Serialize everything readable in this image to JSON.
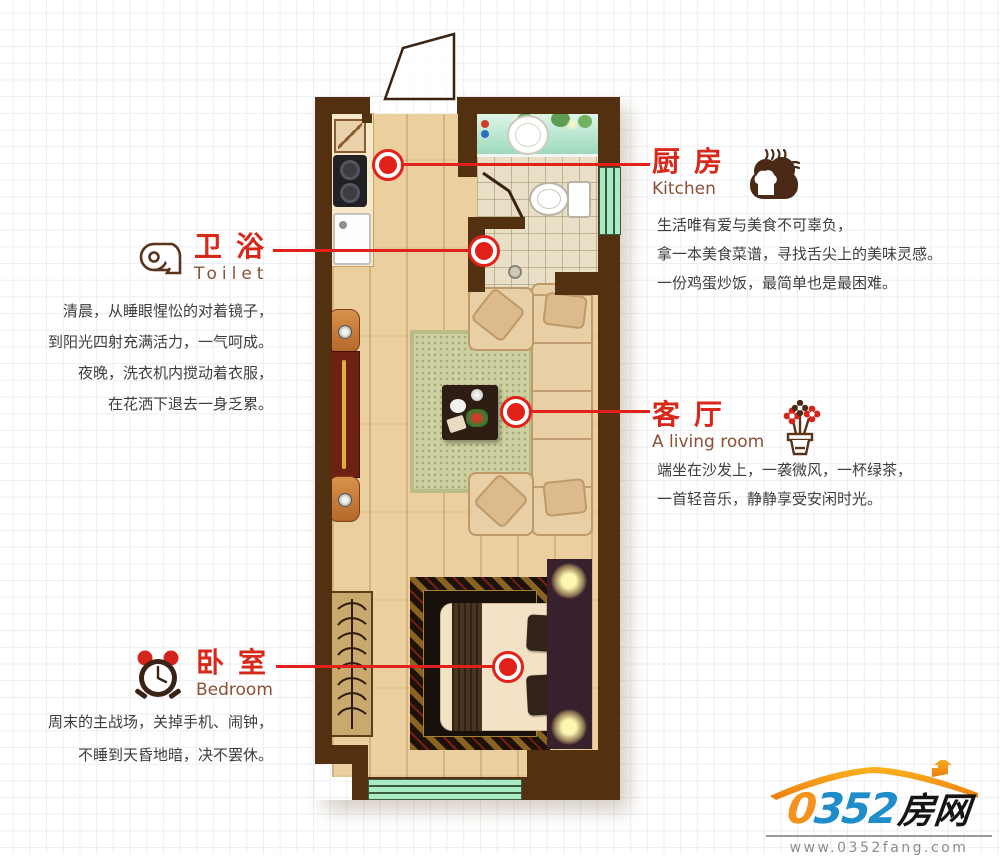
{
  "sections": {
    "kitchen": {
      "title_zh": "厨房",
      "title_en": "Kitchen",
      "icon": "bread-icon",
      "lines": [
        "生活唯有爱与美食不可辜负，",
        "拿一本美食菜谱，寻找舌尖上的美味灵感。",
        "一份鸡蛋炒饭，最简单也是最困难。"
      ]
    },
    "toilet": {
      "title_zh": "卫浴",
      "title_en": "Toilet",
      "icon": "toilet-paper-icon",
      "lines": [
        "清晨，从睡眼惺忪的对着镜子，",
        "到阳光四射充满活力，一气呵成。",
        "夜晚，洗衣机内搅动着衣服，",
        "在花洒下退去一身乏累。"
      ]
    },
    "living": {
      "title_zh": "客厅",
      "title_en": "A living room",
      "icon": "flower-pot-icon",
      "lines": [
        "端坐在沙发上，一袭微风，一杯绿茶，",
        "一首轻音乐，静静享受安闲时光。"
      ]
    },
    "bedroom": {
      "title_zh": "卧室",
      "title_en": "Bedroom",
      "icon": "alarm-clock-icon",
      "lines": [
        "周末的主战场，关掉手机、闹钟，",
        "不睡到天昏地暗，决不罢休。"
      ]
    }
  },
  "logo": {
    "brand_0": "0",
    "brand_352": "352",
    "brand_cn": "房网",
    "url": "www.0352fang.com",
    "icon": "roof-icon"
  },
  "colors": {
    "callout_red": "#e2211a",
    "label_red": "#d8281a",
    "label_en_brown": "#8a5136",
    "body_text": "#3e3e3e",
    "wall_brown": "#53300f",
    "window_mint": "#a7ecc4",
    "wood_floor": "#ebcf9f",
    "brand_orange": "#f3921d",
    "brand_blue": "#1e8dca"
  }
}
